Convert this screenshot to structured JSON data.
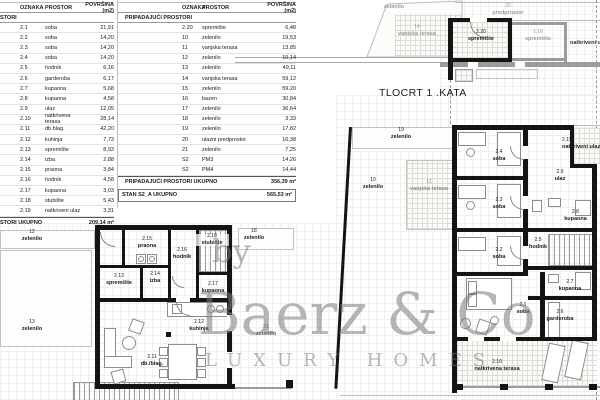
{
  "title": "TLOCRT 1 .KATA",
  "tables": {
    "columns": [
      "OZNAKA",
      "PROSTOR",
      "POVRŠINA (m2)"
    ],
    "left": {
      "section": "STORI",
      "rows": [
        [
          "2.1",
          "soba",
          "21,91"
        ],
        [
          "2.2",
          "soba",
          "14,20"
        ],
        [
          "2.3",
          "soba",
          "14,20"
        ],
        [
          "2.4",
          "soba",
          "14,20"
        ],
        [
          "2.5",
          "hodnik",
          "6,16"
        ],
        [
          "2.6",
          "garderoba",
          "6,17"
        ],
        [
          "2.7",
          "kupaona",
          "5,68"
        ],
        [
          "2.8",
          "kupaona",
          "4,58"
        ],
        [
          "2.9",
          "ulaz",
          "12,05"
        ],
        [
          "2.10",
          "natkrivena terasa",
          "28,14"
        ],
        [
          "2.11",
          "db.blag.",
          "42,20"
        ],
        [
          "2.12",
          "kuhinja",
          "7,73"
        ],
        [
          "2.13",
          "spremište",
          "8,93"
        ],
        [
          "2.14",
          "izba",
          "2,88"
        ],
        [
          "2.15",
          "praona",
          "3,84"
        ],
        [
          "2.16",
          "hodnik",
          "4,58"
        ],
        [
          "2.17",
          "kupaona",
          "3,03"
        ],
        [
          "2.18",
          "stubište",
          "5,43"
        ],
        [
          "2.19",
          "natkriveni ulaz",
          "3,31"
        ]
      ],
      "total_label": "STORI UKUPNO",
      "total_value": "209,14 m²"
    },
    "mid": {
      "section": "PRIPADAJUĆI PROSTORI",
      "rows": [
        [
          "2.20",
          "spremište",
          "6,48"
        ],
        [
          "10",
          "zelenilo",
          "19,53"
        ],
        [
          "11",
          "vanjska terasa",
          "13,85"
        ],
        [
          "12",
          "zelenilo",
          "10,14"
        ],
        [
          "13",
          "zelenilo",
          "49,11"
        ],
        [
          "14",
          "vanjska terasa",
          "59,12"
        ],
        [
          "15",
          "zelenilo",
          "59,20"
        ],
        [
          "16",
          "bazen",
          "30,84"
        ],
        [
          "17",
          "zelenilo",
          "36,64"
        ],
        [
          "18",
          "zelenilo",
          "3,33"
        ],
        [
          "19",
          "zelenilo",
          "17,82"
        ],
        [
          "20",
          "ulazni predprostor",
          "16,38"
        ],
        [
          "21",
          "zelenilo",
          "7,25"
        ],
        [
          "S2",
          "PM3",
          "14,26"
        ],
        [
          "S2",
          "PM4",
          "14,44"
        ]
      ],
      "total_label": "PRIPADAJUĆI PROSTORI UKUPNO",
      "total_value": "356,39 m²",
      "grand_label": "STAN S2_A UKUPNO",
      "grand_value": "565,53 m²"
    }
  },
  "plan": {
    "z15": {
      "name": "zelenilo"
    },
    "t14": {
      "num": "14",
      "name": "vanjska terasa"
    },
    "predprostor": {
      "num": "20",
      "name": "predprostor"
    },
    "s220": {
      "num": "2.20",
      "name": "spremište"
    },
    "s116": {
      "num": "1.16",
      "name": "spremište"
    },
    "natk_top": {
      "name": "natkriveni ulaz"
    },
    "z19": {
      "num": "19",
      "name": "zelenilo"
    },
    "z10": {
      "num": "10",
      "name": "zelenilo"
    },
    "t11": {
      "num": "11",
      "name": "vanjska terasa"
    },
    "r24": {
      "num": "2.4",
      "name": "soba"
    },
    "r23": {
      "num": "2.3",
      "name": "soba"
    },
    "r22": {
      "num": "2.2",
      "name": "soba"
    },
    "r21": {
      "num": "2.1",
      "name": "soba"
    },
    "r29": {
      "num": "2.9",
      "name": "ulaz"
    },
    "r219": {
      "num": "2.19",
      "name": "natkriveni ulaz"
    },
    "r28": {
      "num": "2.8",
      "name": "kupaona"
    },
    "r25": {
      "num": "2.5",
      "name": "hodnik"
    },
    "r27": {
      "num": "2.7",
      "name": "kupaona"
    },
    "r26": {
      "num": "2.6",
      "name": "garderoba"
    },
    "r210": {
      "num": "2.10",
      "name": "natkrivena terasa"
    },
    "z12": {
      "num": "12",
      "name": "zelenilo"
    },
    "z13": {
      "num": "13",
      "name": "zelenilo"
    },
    "z18": {
      "num": "18",
      "name": "zelenilo"
    },
    "z21": {
      "num": "21",
      "name": "zelenilo"
    },
    "r215": {
      "num": "2.15",
      "name": "praona"
    },
    "r216": {
      "num": "2.16",
      "name": "hodnik"
    },
    "r213": {
      "num": "2.13",
      "name": "spremište"
    },
    "r214": {
      "num": "2.14",
      "name": "izba"
    },
    "r218": {
      "num": "2.18",
      "name": "stubište"
    },
    "r217": {
      "num": "2.17",
      "name": "kupaona"
    },
    "r212": {
      "num": "2.12",
      "name": "kuhinja"
    },
    "r211": {
      "num": "2.11",
      "name": "db./blag."
    }
  },
  "watermark": {
    "by": "by",
    "brand": "Baerz & Co",
    "tagline": "LUXURY HOMES"
  }
}
